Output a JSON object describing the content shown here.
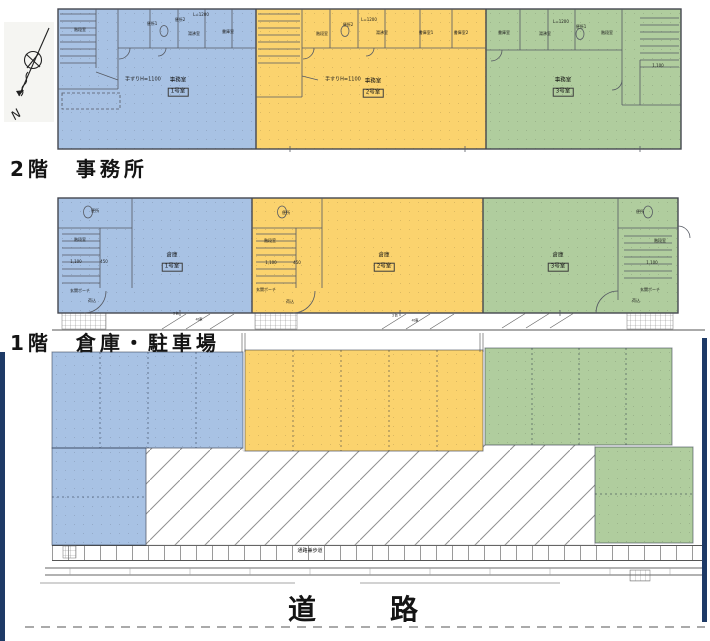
{
  "colors": {
    "unit1_blue": "#a8c2e4",
    "unit2_yellow": "#fbd36e",
    "unit3_green": "#b0cd9e",
    "boundary_navy": "#1e3a66"
  },
  "compass": {
    "label": "N"
  },
  "floor2": {
    "label": "2階　事務所",
    "units": [
      {
        "use": "事務室",
        "room": "1号室"
      },
      {
        "use": "事務室",
        "room": "2号室"
      },
      {
        "use": "事務室",
        "room": "3号室"
      }
    ]
  },
  "floor1": {
    "label": "1階　倉庫・駐車場",
    "units": [
      {
        "use": "倉庫",
        "room": "1号室"
      },
      {
        "use": "倉庫",
        "room": "2号室"
      },
      {
        "use": "倉庫",
        "room": "3号室"
      }
    ]
  },
  "road": {
    "label": "道　　路"
  },
  "sidewalk": {
    "label": "通路兼歩道"
  },
  "small_labels": [
    {
      "id": "f2-u1-kaidan",
      "t": "階段室",
      "x": 80,
      "y": 30,
      "fs": 4
    },
    {
      "id": "f2-u1-benjo1",
      "t": "便所1",
      "x": 152,
      "y": 24,
      "fs": 4
    },
    {
      "id": "f2-u1-benjo2",
      "t": "便所2",
      "x": 180,
      "y": 20,
      "fs": 4
    },
    {
      "id": "f2-u1-l1200",
      "t": "L=1200",
      "x": 201,
      "y": 15,
      "fs": 4
    },
    {
      "id": "f2-u1-yuwakashi",
      "t": "湯沸室",
      "x": 194,
      "y": 34,
      "fs": 4
    },
    {
      "id": "f2-u1-shoko",
      "t": "書庫室",
      "x": 228,
      "y": 32,
      "fs": 4
    },
    {
      "id": "f2-u1-tesuri",
      "t": "手すりH=1100",
      "x": 143,
      "y": 80,
      "fs": 5
    },
    {
      "id": "f2-u2-kaidan",
      "t": "階段室",
      "x": 322,
      "y": 34,
      "fs": 4
    },
    {
      "id": "f2-u2-benjo2",
      "t": "便所2",
      "x": 348,
      "y": 25,
      "fs": 4
    },
    {
      "id": "f2-u2-l1200",
      "t": "L=1200",
      "x": 369,
      "y": 20,
      "fs": 4
    },
    {
      "id": "f2-u2-yuwakashi",
      "t": "湯沸室",
      "x": 382,
      "y": 33,
      "fs": 4
    },
    {
      "id": "f2-u2-shoko1",
      "t": "書庫室1",
      "x": 426,
      "y": 33,
      "fs": 4
    },
    {
      "id": "f2-u2-shoko2",
      "t": "書庫室2",
      "x": 461,
      "y": 33,
      "fs": 4
    },
    {
      "id": "f2-u2-tesuri",
      "t": "手すりH=1100",
      "x": 343,
      "y": 80,
      "fs": 5
    },
    {
      "id": "f2-u3-shoko",
      "t": "書庫室",
      "x": 504,
      "y": 33,
      "fs": 4
    },
    {
      "id": "f2-u3-yuwakashi",
      "t": "湯沸室",
      "x": 545,
      "y": 34,
      "fs": 4
    },
    {
      "id": "f2-u3-l1200",
      "t": "L=1200",
      "x": 561,
      "y": 22,
      "fs": 4
    },
    {
      "id": "f2-u3-benjo",
      "t": "便所1",
      "x": 581,
      "y": 27,
      "fs": 4
    },
    {
      "id": "f2-u3-kaidan",
      "t": "階段室",
      "x": 607,
      "y": 33,
      "fs": 4
    },
    {
      "id": "f2-u3-dim",
      "t": "1,100",
      "x": 658,
      "y": 66,
      "fs": 4
    },
    {
      "id": "f1-u1-benjo",
      "t": "便所",
      "x": 95,
      "y": 211,
      "fs": 4
    },
    {
      "id": "f1-u1-kaidan",
      "t": "階段室",
      "x": 80,
      "y": 240,
      "fs": 4
    },
    {
      "id": "f1-u1-dim1",
      "t": "1,100",
      "x": 76,
      "y": 262,
      "fs": 4
    },
    {
      "id": "f1-u1-dim2",
      "t": "450",
      "x": 104,
      "y": 262,
      "fs": 4
    },
    {
      "id": "f1-u1-genkan",
      "t": "玄関ポーチ",
      "x": 80,
      "y": 291,
      "fs": 4
    },
    {
      "id": "f1-u1-nikomi",
      "t": "荷込",
      "x": 92,
      "y": 301,
      "fs": 4
    },
    {
      "id": "f1-u2-benjo",
      "t": "便所",
      "x": 286,
      "y": 213,
      "fs": 4
    },
    {
      "id": "f1-u2-kaidan",
      "t": "階段室",
      "x": 270,
      "y": 241,
      "fs": 4
    },
    {
      "id": "f1-u2-dim1",
      "t": "1,100",
      "x": 271,
      "y": 263,
      "fs": 4
    },
    {
      "id": "f1-u2-dim2",
      "t": "450",
      "x": 297,
      "y": 263,
      "fs": 4
    },
    {
      "id": "f1-u2-genkan",
      "t": "玄関ポーチ",
      "x": 266,
      "y": 290,
      "fs": 4
    },
    {
      "id": "f1-u2-nikomi",
      "t": "荷込",
      "x": 290,
      "y": 302,
      "fs": 4
    },
    {
      "id": "f1-u3-benjo",
      "t": "便所",
      "x": 640,
      "y": 212,
      "fs": 4
    },
    {
      "id": "f1-u3-kaidan",
      "t": "階段室",
      "x": 660,
      "y": 241,
      "fs": 4
    },
    {
      "id": "f1-u3-dim1",
      "t": "1,100",
      "x": 652,
      "y": 263,
      "fs": 4
    },
    {
      "id": "f1-u3-genkan",
      "t": "玄関ポーチ",
      "x": 650,
      "y": 290,
      "fs": 4
    },
    {
      "id": "f1-u3-nikomi",
      "t": "荷込",
      "x": 636,
      "y": 301,
      "fs": 4
    },
    {
      "id": "strip-2dai-1",
      "t": "2台",
      "x": 176,
      "y": 314,
      "fs": 3.5
    },
    {
      "id": "strip-4t-1",
      "t": "4t車",
      "x": 199,
      "y": 320,
      "fs": 3.5
    },
    {
      "id": "strip-2dai-2",
      "t": "2台",
      "x": 395,
      "y": 316,
      "fs": 3.5
    },
    {
      "id": "strip-4t-2",
      "t": "4t車",
      "x": 415,
      "y": 321,
      "fs": 3.5
    }
  ]
}
